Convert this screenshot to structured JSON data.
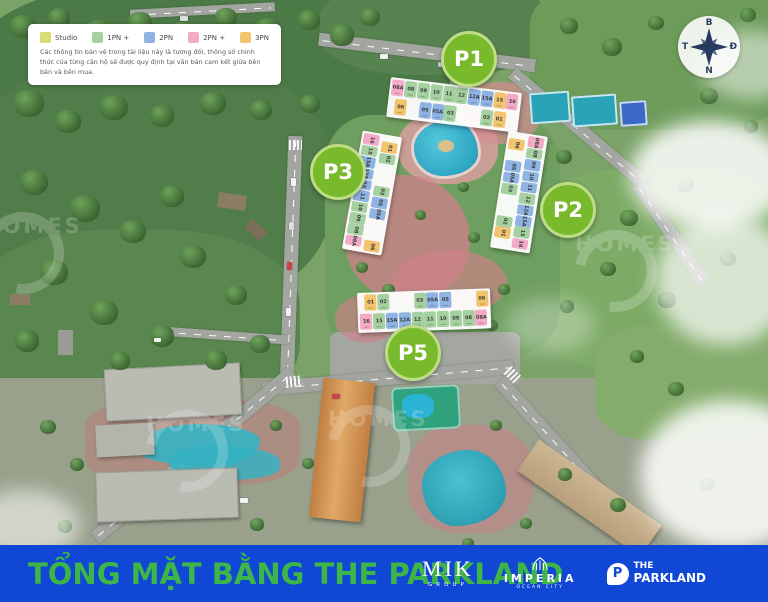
{
  "legend": {
    "items": [
      {
        "label": "Studio",
        "type": "studio"
      },
      {
        "label": "1PN +",
        "type": "1pn"
      },
      {
        "label": "2PN",
        "type": "2pn"
      },
      {
        "label": "2PN +",
        "type": "2pnp"
      },
      {
        "label": "3PN",
        "type": "3pn"
      }
    ],
    "disclaimer": "Các thông tin bản vẽ trong tài liệu này là tương đối, thông số chính thức của từng căn hộ sẽ được quy định tại văn bản cam kết giữa bên bán và bên mua."
  },
  "colors": {
    "studio": "#d8dc72",
    "1pn": "#a5d0a0",
    "2pn": "#8fb3e2",
    "2pnp": "#f2aac6",
    "3pn": "#f2c46d",
    "marker": "#79ba2c",
    "footer": "#1047d4",
    "title": "#3db549"
  },
  "compass": {
    "n": "B",
    "e": "Đ",
    "s": "N",
    "w": "T"
  },
  "markers": [
    {
      "label": "P1"
    },
    {
      "label": "P2"
    },
    {
      "label": "P3"
    },
    {
      "label": "P5"
    }
  ],
  "buildings": {
    "p1": {
      "rows": [
        [
          {
            "l": "08A",
            "t": "2pnp"
          },
          {
            "l": "08",
            "t": "1pn"
          },
          {
            "l": "09",
            "t": "1pn"
          },
          {
            "l": "10",
            "t": "1pn"
          },
          {
            "l": "11",
            "t": "1pn"
          },
          {
            "l": "12",
            "t": "1pn"
          },
          {
            "l": "12A",
            "t": "2pn"
          },
          {
            "l": "15A",
            "t": "2pn"
          },
          {
            "l": "15",
            "t": "3pn"
          },
          {
            "l": "16",
            "t": "2pnp"
          }
        ],
        [
          {
            "l": "06",
            "t": "3pn"
          },
          {
            "l": "05",
            "t": "2pn",
            "g": 1
          },
          {
            "l": "05A",
            "t": "2pn"
          },
          {
            "l": "03",
            "t": "1pn"
          },
          {
            "l": "02",
            "t": "1pn",
            "g": 2
          },
          {
            "l": "01",
            "t": "3pn"
          }
        ]
      ]
    },
    "p2": {
      "cols": [
        [
          {
            "l": "06",
            "t": "3pn"
          },
          {
            "l": "05",
            "t": "2pn",
            "g": 1
          },
          {
            "l": "05A",
            "t": "2pn"
          },
          {
            "l": "03",
            "t": "1pn"
          },
          {
            "l": "02",
            "t": "1pn",
            "g": 2
          },
          {
            "l": "01",
            "t": "3pn"
          }
        ],
        [
          {
            "l": "08A",
            "t": "2pnp"
          },
          {
            "l": "08",
            "t": "1pn"
          },
          {
            "l": "09",
            "t": "2pn"
          },
          {
            "l": "10",
            "t": "2pn"
          },
          {
            "l": "11",
            "t": "2pn"
          },
          {
            "l": "12",
            "t": "1pn"
          },
          {
            "l": "12A",
            "t": "2pn"
          },
          {
            "l": "15A",
            "t": "2pn"
          },
          {
            "l": "15",
            "t": "1pn"
          },
          {
            "l": "16",
            "t": "2pnp"
          }
        ]
      ]
    },
    "p3": {
      "cols": [
        [
          {
            "l": "16",
            "t": "2pnp"
          },
          {
            "l": "15",
            "t": "1pn"
          },
          {
            "l": "15A",
            "t": "2pn"
          },
          {
            "l": "12A",
            "t": "2pn"
          },
          {
            "l": "12",
            "t": "2pn"
          },
          {
            "l": "11",
            "t": "2pn"
          },
          {
            "l": "10",
            "t": "1pn"
          },
          {
            "l": "09",
            "t": "1pn"
          },
          {
            "l": "08",
            "t": "1pn"
          },
          {
            "l": "08A",
            "t": "2pnp"
          }
        ],
        [
          {
            "l": "01",
            "t": "3pn"
          },
          {
            "l": "02",
            "t": "1pn"
          },
          {
            "l": "03",
            "t": "1pn",
            "g": 2
          },
          {
            "l": "05",
            "t": "2pn"
          },
          {
            "l": "05A",
            "t": "2pn"
          },
          {
            "l": "06",
            "t": "3pn",
            "g": 2
          }
        ]
      ]
    },
    "p5": {
      "rows": [
        [
          {
            "l": "01",
            "t": "3pn"
          },
          {
            "l": "02",
            "t": "1pn"
          },
          {
            "l": "03",
            "t": "1pn",
            "g": 2
          },
          {
            "l": "05A",
            "t": "2pn"
          },
          {
            "l": "05",
            "t": "2pn"
          },
          {
            "l": "06",
            "t": "3pn",
            "g": 2
          }
        ],
        [
          {
            "l": "16",
            "t": "2pnp"
          },
          {
            "l": "15",
            "t": "1pn"
          },
          {
            "l": "15A",
            "t": "2pn"
          },
          {
            "l": "12A",
            "t": "2pn"
          },
          {
            "l": "12",
            "t": "1pn"
          },
          {
            "l": "11",
            "t": "1pn"
          },
          {
            "l": "10",
            "t": "1pn"
          },
          {
            "l": "09",
            "t": "1pn"
          },
          {
            "l": "08",
            "t": "1pn"
          },
          {
            "l": "08A",
            "t": "2pnp"
          }
        ]
      ]
    }
  },
  "watermark": {
    "text": "HOMES"
  },
  "footer": {
    "title": "TỔNG MẶT BẰNG THE PARKLAND",
    "logos": {
      "mik": {
        "name": "MIK",
        "sub": "GROUP"
      },
      "imperia": {
        "name": "IMPERIA",
        "sub": "OCEAN CITY"
      },
      "parkland": {
        "icon_letter": "P",
        "line1": "THE",
        "line2": "PARKLAND"
      }
    }
  }
}
